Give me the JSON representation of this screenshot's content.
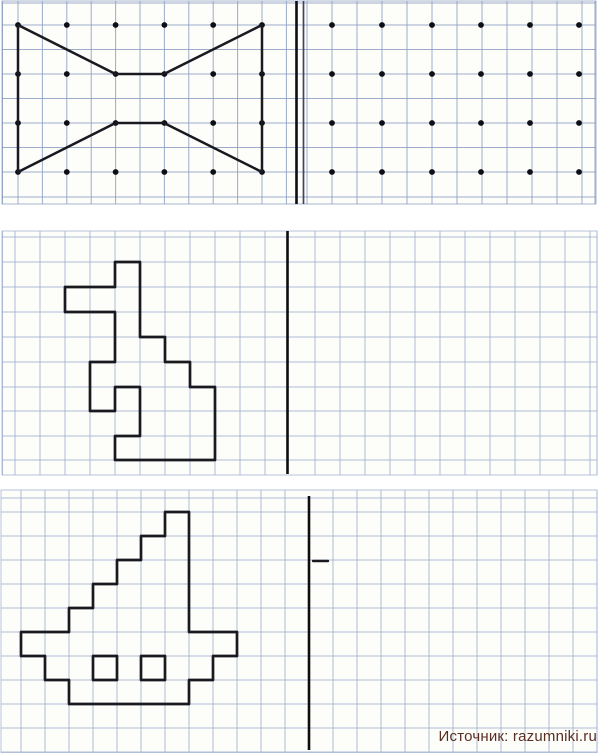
{
  "page": {
    "width": 600,
    "height": 753,
    "bg": "#ffffff"
  },
  "credit": {
    "text": "Источник: razumniki.ru",
    "color": "#5a2d23"
  },
  "colors": {
    "grid1": "#8d9dc2",
    "grid2": "#a2b1d2",
    "panel_bg": "#fdfdfa",
    "ink": "#191920",
    "axis": "#0d0d12",
    "axis_secondary": "#3d4560",
    "dot": "#0e0e16"
  },
  "panels": [
    {
      "name": "task-bowtie",
      "rect": {
        "x": 2,
        "y": 1,
        "w": 594,
        "h": 203
      },
      "grid": {
        "color_key": "grid1",
        "cols": [
          2.5,
          18,
          42.4,
          66.8,
          91.2,
          115.6,
          140,
          164.4,
          188.8,
          213.2,
          237.6,
          262,
          286.4,
          307,
          332,
          357,
          382,
          407,
          432,
          457,
          482,
          507,
          532,
          557,
          582,
          595
        ],
        "rows": [
          3,
          25,
          49.5,
          74,
          98.5,
          123,
          147.5,
          172,
          197
        ]
      },
      "axes": [
        {
          "x": 296.5,
          "y1": 1,
          "y2": 204,
          "width": 2.6,
          "color_key": "axis"
        },
        {
          "x": 303.5,
          "y1": 1,
          "y2": 204,
          "width": 1.7,
          "color_key": "axis_secondary"
        }
      ],
      "dots": {
        "xs": [
          18,
          66.8,
          115.6,
          164.4,
          213.2,
          262,
          332,
          382,
          432,
          481,
          530,
          579
        ],
        "ys": [
          25,
          74,
          123,
          172
        ],
        "radius": 2.9
      },
      "figures": [
        {
          "name": "bow-tie-shape",
          "closed": true,
          "stroke_width": 2.5,
          "points": [
            [
              18,
              25
            ],
            [
              115.5,
              74
            ],
            [
              164,
              74
            ],
            [
              262,
              25
            ],
            [
              262,
              172
            ],
            [
              164,
              123
            ],
            [
              115.5,
              123
            ],
            [
              18,
              172
            ]
          ]
        }
      ]
    },
    {
      "name": "task-hare",
      "rect": {
        "x": 2,
        "y": 231,
        "w": 595,
        "h": 244
      },
      "grid": {
        "color_key": "grid2",
        "cols": [
          2.5,
          15,
          40,
          65,
          90,
          115,
          140,
          165,
          190,
          215,
          240,
          265,
          315,
          340,
          365,
          390,
          415,
          440,
          465,
          490,
          515,
          540,
          565,
          590,
          597
        ],
        "rows": [
          237,
          262,
          287,
          312,
          337,
          362,
          387,
          411,
          436,
          460
        ]
      },
      "axes": [
        {
          "x": 287.5,
          "y1": 231,
          "y2": 474,
          "width": 2.6,
          "color_key": "axis"
        }
      ],
      "dots": null,
      "figures": [
        {
          "name": "hare-shape",
          "closed": true,
          "stroke_width": 2.7,
          "points": [
            [
              115,
              262
            ],
            [
              140,
              262
            ],
            [
              140,
              337
            ],
            [
              165,
              337
            ],
            [
              165,
              362
            ],
            [
              190,
              362
            ],
            [
              190,
              387
            ],
            [
              215,
              387
            ],
            [
              215,
              460
            ],
            [
              115,
              460
            ],
            [
              115,
              436
            ],
            [
              140,
              436
            ],
            [
              140,
              387
            ],
            [
              115,
              387
            ],
            [
              115,
              411
            ],
            [
              90,
              411
            ],
            [
              90,
              362
            ],
            [
              115,
              362
            ],
            [
              115,
              312
            ],
            [
              65,
              312
            ],
            [
              65,
              287
            ],
            [
              115,
              287
            ]
          ]
        }
      ]
    },
    {
      "name": "task-boat",
      "rect": {
        "x": 1,
        "y": 490,
        "w": 596,
        "h": 263
      },
      "grid": {
        "color_key": "grid2",
        "cols": [
          21,
          45,
          69,
          93,
          117,
          141,
          165,
          189,
          213,
          237,
          261,
          285,
          333,
          357,
          381,
          405,
          429,
          453,
          477,
          501,
          525,
          549,
          573,
          597
        ],
        "rows": [
          498,
          512,
          536,
          560,
          584,
          608,
          632,
          656,
          680,
          704,
          728,
          752
        ]
      },
      "axes": [
        {
          "x": 309,
          "y1": 496,
          "y2": 750,
          "width": 2.6,
          "color_key": "axis"
        }
      ],
      "dots": null,
      "figures": [
        {
          "name": "boat-shape",
          "closed": true,
          "stroke_width": 2.7,
          "points": [
            [
              165,
              512
            ],
            [
              189,
              512
            ],
            [
              189,
              632
            ],
            [
              237,
              632
            ],
            [
              237,
              656
            ],
            [
              213,
              656
            ],
            [
              213,
              680
            ],
            [
              189,
              680
            ],
            [
              189,
              704
            ],
            [
              69,
              704
            ],
            [
              69,
              680
            ],
            [
              45,
              680
            ],
            [
              45,
              656
            ],
            [
              21,
              656
            ],
            [
              21,
              632
            ],
            [
              69,
              632
            ],
            [
              69,
              608
            ],
            [
              93,
              608
            ],
            [
              93,
              584
            ],
            [
              117,
              584
            ],
            [
              117,
              560
            ],
            [
              141,
              560
            ],
            [
              141,
              536
            ],
            [
              165,
              536
            ]
          ]
        },
        {
          "name": "boat-window-left",
          "closed": true,
          "stroke_width": 2.7,
          "points": [
            [
              93,
              656
            ],
            [
              117,
              656
            ],
            [
              117,
              680
            ],
            [
              93,
              680
            ]
          ]
        },
        {
          "name": "boat-window-right",
          "closed": true,
          "stroke_width": 2.7,
          "points": [
            [
              141,
              656
            ],
            [
              165,
              656
            ],
            [
              165,
              680
            ],
            [
              141,
              680
            ]
          ]
        },
        {
          "name": "stray-dash",
          "closed": false,
          "stroke_width": 2.4,
          "points": [
            [
              313,
              561
            ],
            [
              328,
              561
            ]
          ]
        }
      ]
    }
  ]
}
